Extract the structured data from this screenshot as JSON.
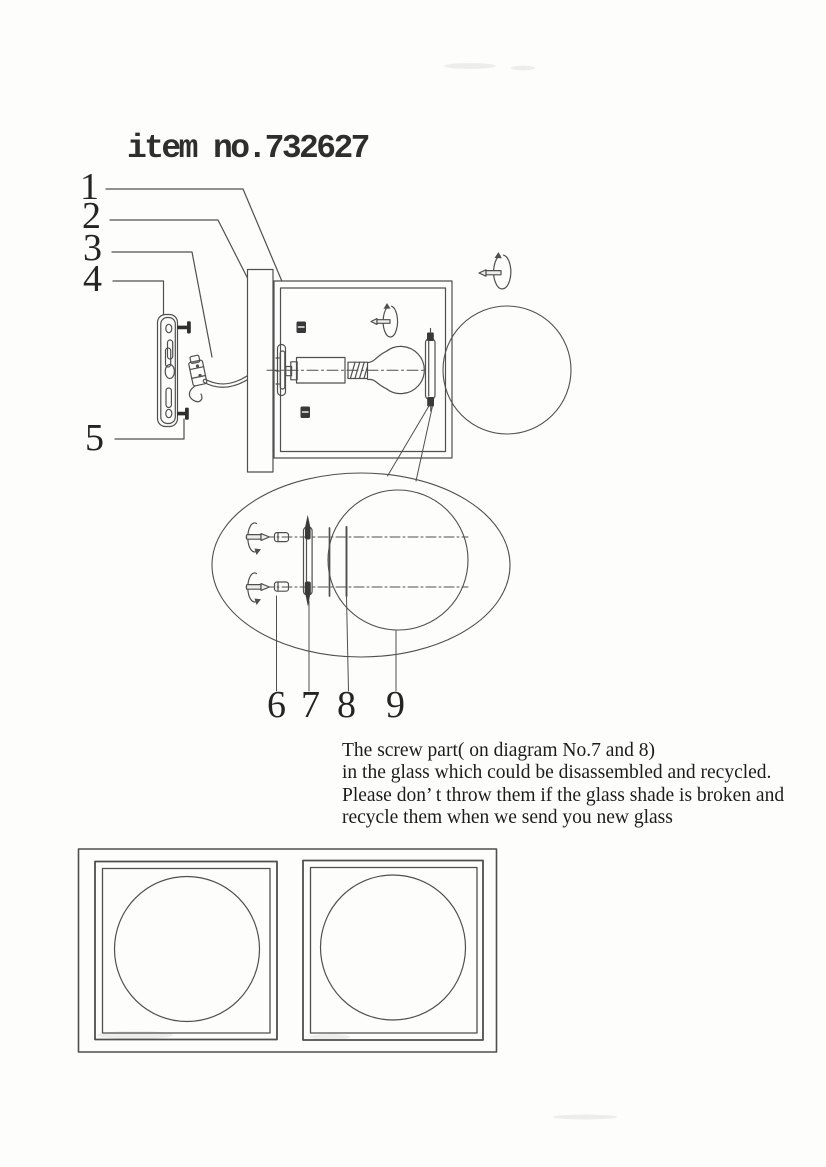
{
  "title": "item no.732627",
  "callouts": [
    "1",
    "2",
    "3",
    "4",
    "5",
    "6",
    "7",
    "8",
    "9"
  ],
  "note": {
    "line1": "The screw part( on diagram No.7 and 8)",
    "line2": "in the glass which could be disassembled and recycled.",
    "line3": "Please don’ t throw them if the glass shade is broken and",
    "line4": "recycle them when we send you new glass"
  },
  "colors": {
    "ink": "#4f4f4f",
    "ink_dark": "#323232",
    "paper": "#fdfdfc"
  },
  "icons": {
    "screw_rotation": "rotating-screw-icon",
    "clip": "clip-block-icon"
  }
}
